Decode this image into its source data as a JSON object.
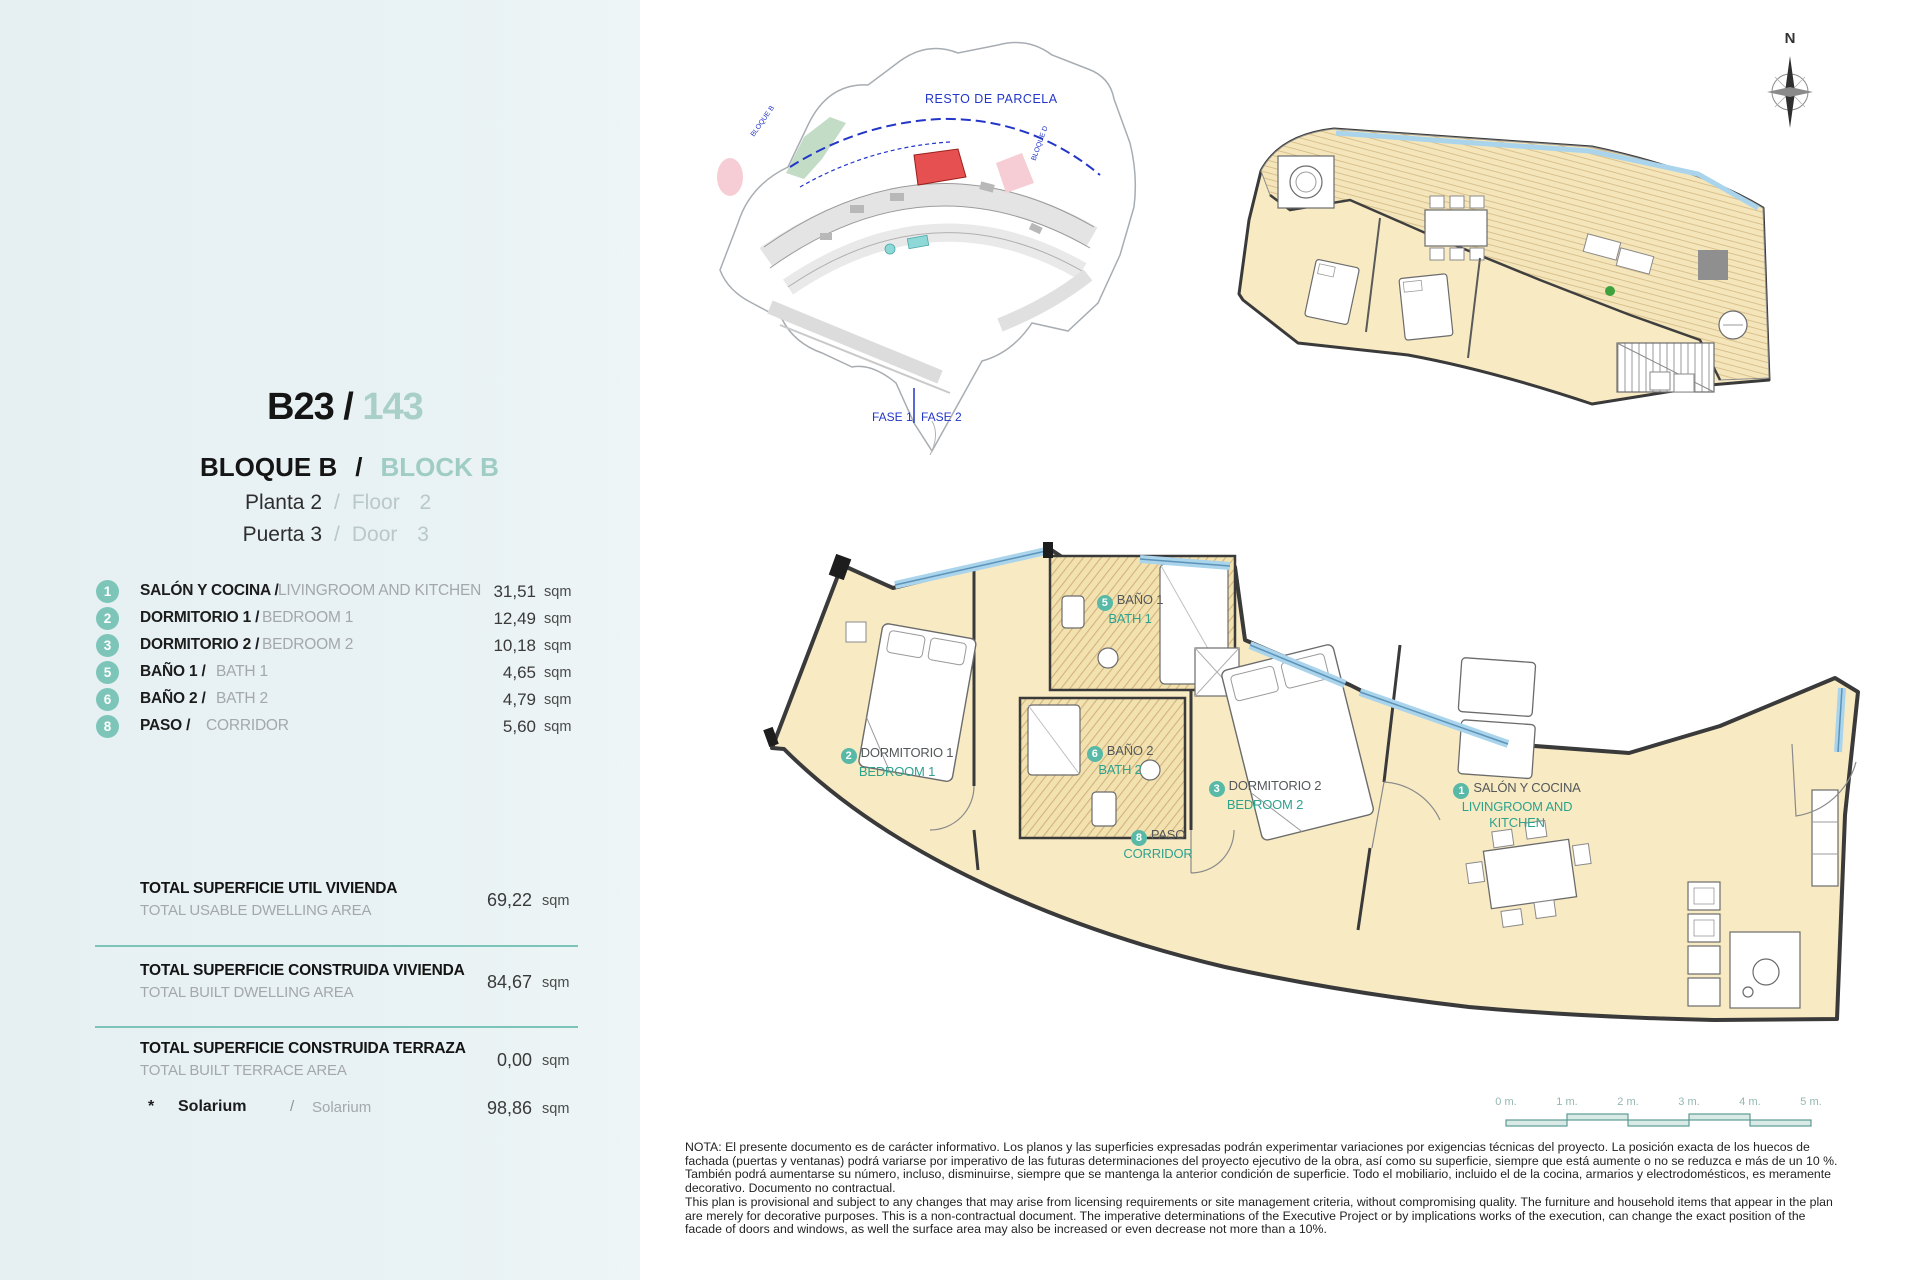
{
  "colors": {
    "sidebar_bg": "#e9f2f4",
    "accent_teal": "#7cc3b8",
    "light_teal_text": "#a9cfc9",
    "gray_text": "#a4a8aa",
    "floor_cream": "#f8ebc4",
    "window_blue": "#a9d4ec",
    "wall_dark": "#3a3a3a",
    "site_red_unit": "#e65050",
    "site_blue": "#2336c8"
  },
  "sidebar": {
    "unit_code": "B23",
    "unit_sep": "/",
    "unit_number": "143",
    "block_es": "BLOQUE B",
    "block_sep": "/",
    "block_en": "BLOCK B",
    "floor_es": "Planta 2",
    "floor_sep": "/",
    "floor_en": "Floor 2",
    "door_es": "Puerta 3",
    "door_sep": "/",
    "door_en": "Door 3",
    "rooms": [
      {
        "num": "1",
        "es": "SALÓN Y COCINA /",
        "en": "LIVINGROOM AND KITCHEN",
        "value": "31,51",
        "unit": "sqm"
      },
      {
        "num": "2",
        "es": "DORMITORIO 1 /",
        "en": "BEDROOM 1",
        "value": "12,49",
        "unit": "sqm"
      },
      {
        "num": "3",
        "es": "DORMITORIO 2 /",
        "en": "BEDROOM 2",
        "value": "10,18",
        "unit": "sqm"
      },
      {
        "num": "5",
        "es": "BAÑO 1 /",
        "en": "BATH 1",
        "value": "4,65",
        "unit": "sqm"
      },
      {
        "num": "6",
        "es": "BAÑO 2 /",
        "en": "BATH 2",
        "value": "4,79",
        "unit": "sqm"
      },
      {
        "num": "8",
        "es": "PASO /",
        "en": "CORRIDOR",
        "value": "5,60",
        "unit": "sqm"
      }
    ],
    "totals": [
      {
        "es": "TOTAL SUPERFICIE UTIL VIVIENDA",
        "en": "TOTAL USABLE DWELLING AREA",
        "value": "69,22",
        "unit": "sqm"
      },
      {
        "es": "TOTAL SUPERFICIE CONSTRUIDA VIVIENDA",
        "en": "TOTAL BUILT DWELLING AREA",
        "value": "84,67",
        "unit": "sqm"
      },
      {
        "es": "TOTAL SUPERFICIE CONSTRUIDA TERRAZA",
        "en": "TOTAL BUILT TERRACE AREA",
        "value": "0,00",
        "unit": "sqm"
      }
    ],
    "solarium": {
      "star": "*",
      "es": "Solarium",
      "sep": "/",
      "en": "Solarium",
      "value": "98,86",
      "unit": "sqm"
    }
  },
  "site_plan": {
    "resto": "RESTO DE PARCELA",
    "fase_1": "FASE 1",
    "fase_2": "FASE 2",
    "bloque_left": "BLOQUE B",
    "bloque_right": "BLOQUE D"
  },
  "compass": {
    "north": "N"
  },
  "floor_plan": {
    "labels": [
      {
        "num": "5",
        "es": "BAÑO 1",
        "en": "BATH 1"
      },
      {
        "num": "2",
        "es": "DORMITORIO 1",
        "en": "BEDROOM 1"
      },
      {
        "num": "6",
        "es": "BAÑO 2",
        "en": "BATH 2"
      },
      {
        "num": "3",
        "es": "DORMITORIO 2",
        "en": "BEDROOM 2"
      },
      {
        "num": "8",
        "es": "PASO",
        "en": "CORRIDOR"
      },
      {
        "num": "1",
        "es": "SALÓN Y COCINA",
        "en": "LIVINGROOM AND KITCHEN"
      }
    ]
  },
  "scale_bar": {
    "labels": [
      "0 m.",
      "1 m.",
      "2 m.",
      "3 m.",
      "4 m.",
      "5 m."
    ]
  },
  "legal_note": {
    "es": "NOTA: El presente documento es de carácter informativo. Los planos y las superficies expresadas podrán experimentar variaciones por exigencias técnicas del proyecto. La posición exacta de los huecos de fachada (puertas y ventanas) podrá variarse por imperativo de las futuras determinaciones del proyecto ejecutivo de la obra, así como su superficie, siempre que está aumente o no se reduzca e más de un 10 %. También podrá aumentarse su número, incluso, disminuirse, siempre que se mantenga la anterior condición de superficie. Todo el mobiliario, incluido el de la cocina, armarios y electrodomésticos, es meramente decorativo. Documento no contractual.",
    "en": "This plan is provisional and subject to any changes that may arise from licensing requirements or site management criteria, without compromising quality. The furniture and household items that appear in the plan are merely for decorative purposes. This is a non-contractual document. The imperative determinations of the Executive Project or by implications works of the execution, can change the exact position of the facade of doors and windows, as well the surface area may also be increased or even decrease not more than a 10%."
  }
}
